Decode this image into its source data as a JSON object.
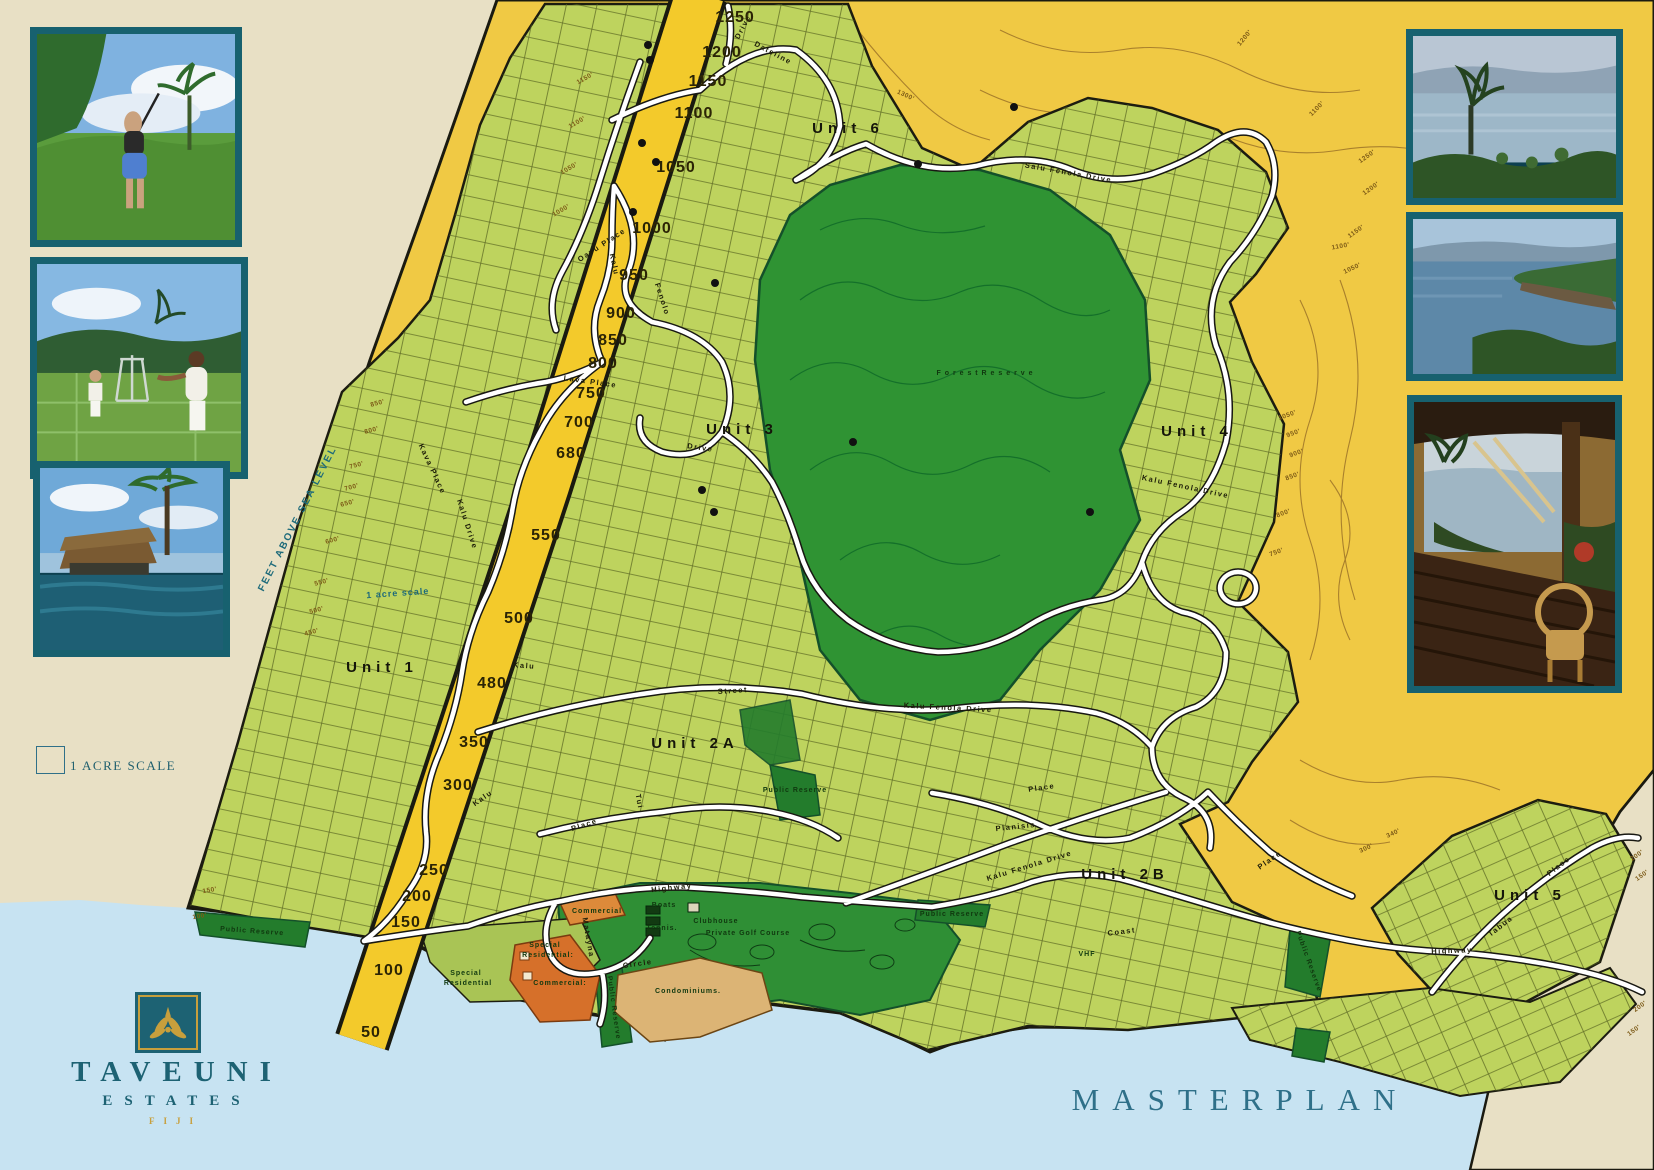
{
  "title": {
    "masterplan": "MASTERPLAN"
  },
  "brand": {
    "name": "TAVEUNI",
    "subname": "ESTATES",
    "country": "FIJI"
  },
  "legend": {
    "acre_scale": "1 ACRE SCALE"
  },
  "colors": {
    "teal_frame": "#17616f",
    "logo_teal": "#1d6273",
    "logo_gold": "#c79f3c",
    "title_teal": "#2f7089",
    "ocean": "#c7e3f2",
    "sand": "#e8e0c5",
    "map_yellow": "#f0c944",
    "band_yellow": "#f3ca2b",
    "parcel_green": "#bed35e",
    "forest_green": "#2f9333",
    "reserve_green": "#237c2c",
    "commercial_orange": "#dd8a3a",
    "condo_tan": "#dcb475",
    "road_white": "#ffffff"
  },
  "photos": {
    "left": [
      {
        "name": "golf-photo",
        "caption": "Golfer on fairway with palms"
      },
      {
        "name": "tennis-photo",
        "caption": "Tennis courts"
      },
      {
        "name": "pool-photo",
        "caption": "Beachfront pool and bure"
      }
    ],
    "right": [
      {
        "name": "ocean-palm-photo",
        "caption": "Ocean and palm view"
      },
      {
        "name": "bay-photo",
        "caption": "Coastal bay"
      },
      {
        "name": "veranda-photo",
        "caption": "Veranda at sunset"
      }
    ]
  },
  "map": {
    "teal_notes": [
      {
        "t": "FEET ABOVE SEA LEVEL",
        "x": 300,
        "y": 520,
        "r": -63,
        "s": 10,
        "ls": 2
      },
      {
        "t": "1 acre scale",
        "x": 398,
        "y": 596,
        "r": -4,
        "s": 9,
        "ls": 1
      }
    ],
    "unit_labels": [
      {
        "t": "Unit  1",
        "x": 382,
        "y": 672
      },
      {
        "t": "Unit  2A",
        "x": 695,
        "y": 748
      },
      {
        "t": "Unit  2B",
        "x": 1125,
        "y": 879
      },
      {
        "t": "Unit  3",
        "x": 742,
        "y": 434
      },
      {
        "t": "Unit  4",
        "x": 1197,
        "y": 436
      },
      {
        "t": "Unit  5",
        "x": 1530,
        "y": 900
      },
      {
        "t": "Unit      6",
        "x": 848,
        "y": 133
      }
    ],
    "area_labels": [
      {
        "t": "F o r e s t   R e s e r v e",
        "x": 985,
        "y": 375,
        "s": 13,
        "c": "#0d3a15",
        "ls": 3
      },
      {
        "t": "Public Reserve",
        "x": 252,
        "y": 933,
        "r": 4,
        "s": 6.5,
        "c": "#titleblack"
      },
      {
        "t": "Public Reserve",
        "x": 795,
        "y": 792,
        "s": 6
      },
      {
        "t": "Public Reserve",
        "x": 952,
        "y": 916,
        "s": 6
      },
      {
        "t": "Public Reserve",
        "x": 1307,
        "y": 962,
        "r": 70,
        "s": 6
      },
      {
        "t": "Public Reserve",
        "x": 612,
        "y": 1008,
        "r": 82,
        "s": 5.5
      },
      {
        "t": "Special",
        "x": 545,
        "y": 947,
        "s": 8
      },
      {
        "t": "Residential:",
        "x": 548,
        "y": 957,
        "s": 8
      },
      {
        "t": "Special",
        "x": 466,
        "y": 975,
        "s": 8
      },
      {
        "t": "Residential",
        "x": 468,
        "y": 985,
        "s": 8
      },
      {
        "t": "Commercial",
        "x": 597,
        "y": 913,
        "s": 8,
        "c": "#7b2310"
      },
      {
        "t": "Commercial:",
        "x": 560,
        "y": 985,
        "s": 8,
        "c": "#7b2310"
      },
      {
        "t": "Condominiums.",
        "x": 688,
        "y": 993,
        "s": 9.5,
        "c": "#7b2310",
        "ls": 1.5
      },
      {
        "t": "Clubhouse",
        "x": 716,
        "y": 923,
        "s": 7,
        "c": "#111608"
      },
      {
        "t": "Tennis.",
        "x": 662,
        "y": 930,
        "s": 7,
        "c": "#111608"
      },
      {
        "t": "Boats",
        "x": 664,
        "y": 907,
        "s": 6,
        "c": "#111608"
      },
      {
        "t": "Private  Golf  Course",
        "x": 748,
        "y": 935,
        "s": 8,
        "c": "#0e3d14",
        "ls": 2
      },
      {
        "t": "VHF",
        "x": 1087,
        "y": 956,
        "s": 12,
        "c": "#2b2b2b",
        "ls": 1
      }
    ],
    "road_labels": [
      {
        "t": "Dateline",
        "x": 772,
        "y": 55,
        "r": 28
      },
      {
        "t": "Drive",
        "x": 745,
        "y": 28,
        "r": -62
      },
      {
        "t": "Salu  Fenola  Drive",
        "x": 1068,
        "y": 175,
        "r": 10
      },
      {
        "t": "Kalu  Fenola  Drive",
        "x": 1185,
        "y": 489,
        "r": 12
      },
      {
        "t": "Kalu  Fenola  Drive",
        "x": 948,
        "y": 710,
        "r": 3
      },
      {
        "t": "Kalu  Fenola  Drive",
        "x": 1030,
        "y": 868,
        "r": -17
      },
      {
        "t": "Kalu",
        "x": 612,
        "y": 265,
        "r": 78
      },
      {
        "t": "Fenolo",
        "x": 660,
        "y": 300,
        "r": 72
      },
      {
        "t": "Drive",
        "x": 700,
        "y": 450,
        "r": 8
      },
      {
        "t": "Lava  Place",
        "x": 590,
        "y": 384,
        "r": 8
      },
      {
        "t": "Oavu  Place",
        "x": 603,
        "y": 247,
        "r": -33
      },
      {
        "t": "Kava  Place",
        "x": 430,
        "y": 470,
        "r": 65
      },
      {
        "t": "Kalu  Drive",
        "x": 465,
        "y": 525,
        "r": 72
      },
      {
        "t": "Street",
        "x": 733,
        "y": 693,
        "r": -4
      },
      {
        "t": "Kalu",
        "x": 524,
        "y": 668,
        "r": 4
      },
      {
        "t": "Kalu",
        "x": 484,
        "y": 800,
        "r": -35
      },
      {
        "t": "Place",
        "x": 585,
        "y": 827,
        "r": -18
      },
      {
        "t": "Tui",
        "x": 637,
        "y": 802,
        "r": 80
      },
      {
        "t": "Highway",
        "x": 672,
        "y": 890,
        "r": -6
      },
      {
        "t": "Coast",
        "x": 1122,
        "y": 934,
        "r": -7
      },
      {
        "t": "Highway",
        "x": 1452,
        "y": 953,
        "r": -2
      },
      {
        "t": "Circle",
        "x": 638,
        "y": 966,
        "r": -8
      },
      {
        "t": "Matayna",
        "x": 586,
        "y": 938,
        "r": 80
      },
      {
        "t": "Planisis",
        "x": 1016,
        "y": 829,
        "r": -6
      },
      {
        "t": "Place",
        "x": 1042,
        "y": 790,
        "r": -8
      },
      {
        "t": "Place",
        "x": 1271,
        "y": 862,
        "r": -35
      },
      {
        "t": "Tabua",
        "x": 1502,
        "y": 928,
        "r": -38
      },
      {
        "t": "Place",
        "x": 1560,
        "y": 868,
        "r": -38
      }
    ],
    "elevation_markers": [
      {
        "t": "1250",
        "x": 735,
        "y": 22
      },
      {
        "t": "1200",
        "x": 722,
        "y": 57
      },
      {
        "t": "1150",
        "x": 708,
        "y": 86
      },
      {
        "t": "1100",
        "x": 694,
        "y": 118
      },
      {
        "t": "1050",
        "x": 676,
        "y": 172
      },
      {
        "t": "1000",
        "x": 652,
        "y": 233
      },
      {
        "t": "950",
        "x": 634,
        "y": 280
      },
      {
        "t": "900",
        "x": 621,
        "y": 318
      },
      {
        "t": "850",
        "x": 613,
        "y": 345
      },
      {
        "t": "800",
        "x": 603,
        "y": 368
      },
      {
        "t": "750",
        "x": 591,
        "y": 398
      },
      {
        "t": "700",
        "x": 579,
        "y": 427
      },
      {
        "t": "680",
        "x": 571,
        "y": 458
      },
      {
        "t": "550",
        "x": 546,
        "y": 540
      },
      {
        "t": "500",
        "x": 519,
        "y": 623
      },
      {
        "t": "480",
        "x": 492,
        "y": 688
      },
      {
        "t": "350",
        "x": 474,
        "y": 747
      },
      {
        "t": "300",
        "x": 458,
        "y": 790
      },
      {
        "t": "250",
        "x": 434,
        "y": 875
      },
      {
        "t": "200",
        "x": 417,
        "y": 901
      },
      {
        "t": "150",
        "x": 406,
        "y": 927
      },
      {
        "t": "100",
        "x": 389,
        "y": 975
      },
      {
        "t": "50",
        "x": 371,
        "y": 1037
      }
    ],
    "contour_labels": [
      {
        "t": "1300'",
        "x": 905,
        "y": 97,
        "r": 25
      },
      {
        "t": "1200'",
        "x": 1246,
        "y": 39,
        "r": -50
      },
      {
        "t": "1100'",
        "x": 1318,
        "y": 110,
        "r": -45
      },
      {
        "t": "1150'",
        "x": 586,
        "y": 80,
        "r": -30
      },
      {
        "t": "1100'",
        "x": 578,
        "y": 124,
        "r": -30
      },
      {
        "t": "1050'",
        "x": 570,
        "y": 170,
        "r": -30
      },
      {
        "t": "1000'",
        "x": 562,
        "y": 212,
        "r": -30
      },
      {
        "t": "1250'",
        "x": 1368,
        "y": 158,
        "r": -35
      },
      {
        "t": "1200'",
        "x": 1372,
        "y": 190,
        "r": -35
      },
      {
        "t": "1150'",
        "x": 1357,
        "y": 233,
        "r": -35
      },
      {
        "t": "1100'",
        "x": 1341,
        "y": 248,
        "r": -10
      },
      {
        "t": "1050'",
        "x": 1353,
        "y": 270,
        "r": -25
      },
      {
        "t": "1050'",
        "x": 1288,
        "y": 417,
        "r": -20
      },
      {
        "t": "950'",
        "x": 1294,
        "y": 435,
        "r": -20
      },
      {
        "t": "900'",
        "x": 1297,
        "y": 455,
        "r": -20
      },
      {
        "t": "850'",
        "x": 1293,
        "y": 478,
        "r": -20
      },
      {
        "t": "800'",
        "x": 1284,
        "y": 515,
        "r": -20
      },
      {
        "t": "750'",
        "x": 1277,
        "y": 554,
        "r": -20
      },
      {
        "t": "850'",
        "x": 378,
        "y": 405,
        "r": -15
      },
      {
        "t": "800'",
        "x": 372,
        "y": 432,
        "r": -15
      },
      {
        "t": "750'",
        "x": 357,
        "y": 467,
        "r": -15
      },
      {
        "t": "700'",
        "x": 352,
        "y": 489,
        "r": -15
      },
      {
        "t": "650'",
        "x": 348,
        "y": 505,
        "r": -15
      },
      {
        "t": "600'",
        "x": 333,
        "y": 542,
        "r": -15
      },
      {
        "t": "550'",
        "x": 322,
        "y": 584,
        "r": -15
      },
      {
        "t": "500'",
        "x": 317,
        "y": 612,
        "r": -15
      },
      {
        "t": "450'",
        "x": 312,
        "y": 634,
        "r": -15
      },
      {
        "t": "340'",
        "x": 1394,
        "y": 835,
        "r": -25
      },
      {
        "t": "300'",
        "x": 1367,
        "y": 850,
        "r": -25
      },
      {
        "t": "200'",
        "x": 1638,
        "y": 857,
        "r": -35
      },
      {
        "t": "150'",
        "x": 1643,
        "y": 877,
        "r": -35
      },
      {
        "t": "200'",
        "x": 1641,
        "y": 1008,
        "r": -35
      },
      {
        "t": "150'",
        "x": 1635,
        "y": 1032,
        "r": -35
      },
      {
        "t": "150'",
        "x": 210,
        "y": 892,
        "r": -10
      },
      {
        "t": "100'",
        "x": 200,
        "y": 918,
        "r": -10
      }
    ],
    "dots": [
      [
        648,
        45
      ],
      [
        650,
        60
      ],
      [
        642,
        143
      ],
      [
        656,
        162
      ],
      [
        633,
        212
      ],
      [
        715,
        283
      ],
      [
        853,
        442
      ],
      [
        702,
        490
      ],
      [
        714,
        512
      ],
      [
        1014,
        107
      ],
      [
        918,
        164
      ],
      [
        1090,
        512
      ]
    ]
  }
}
